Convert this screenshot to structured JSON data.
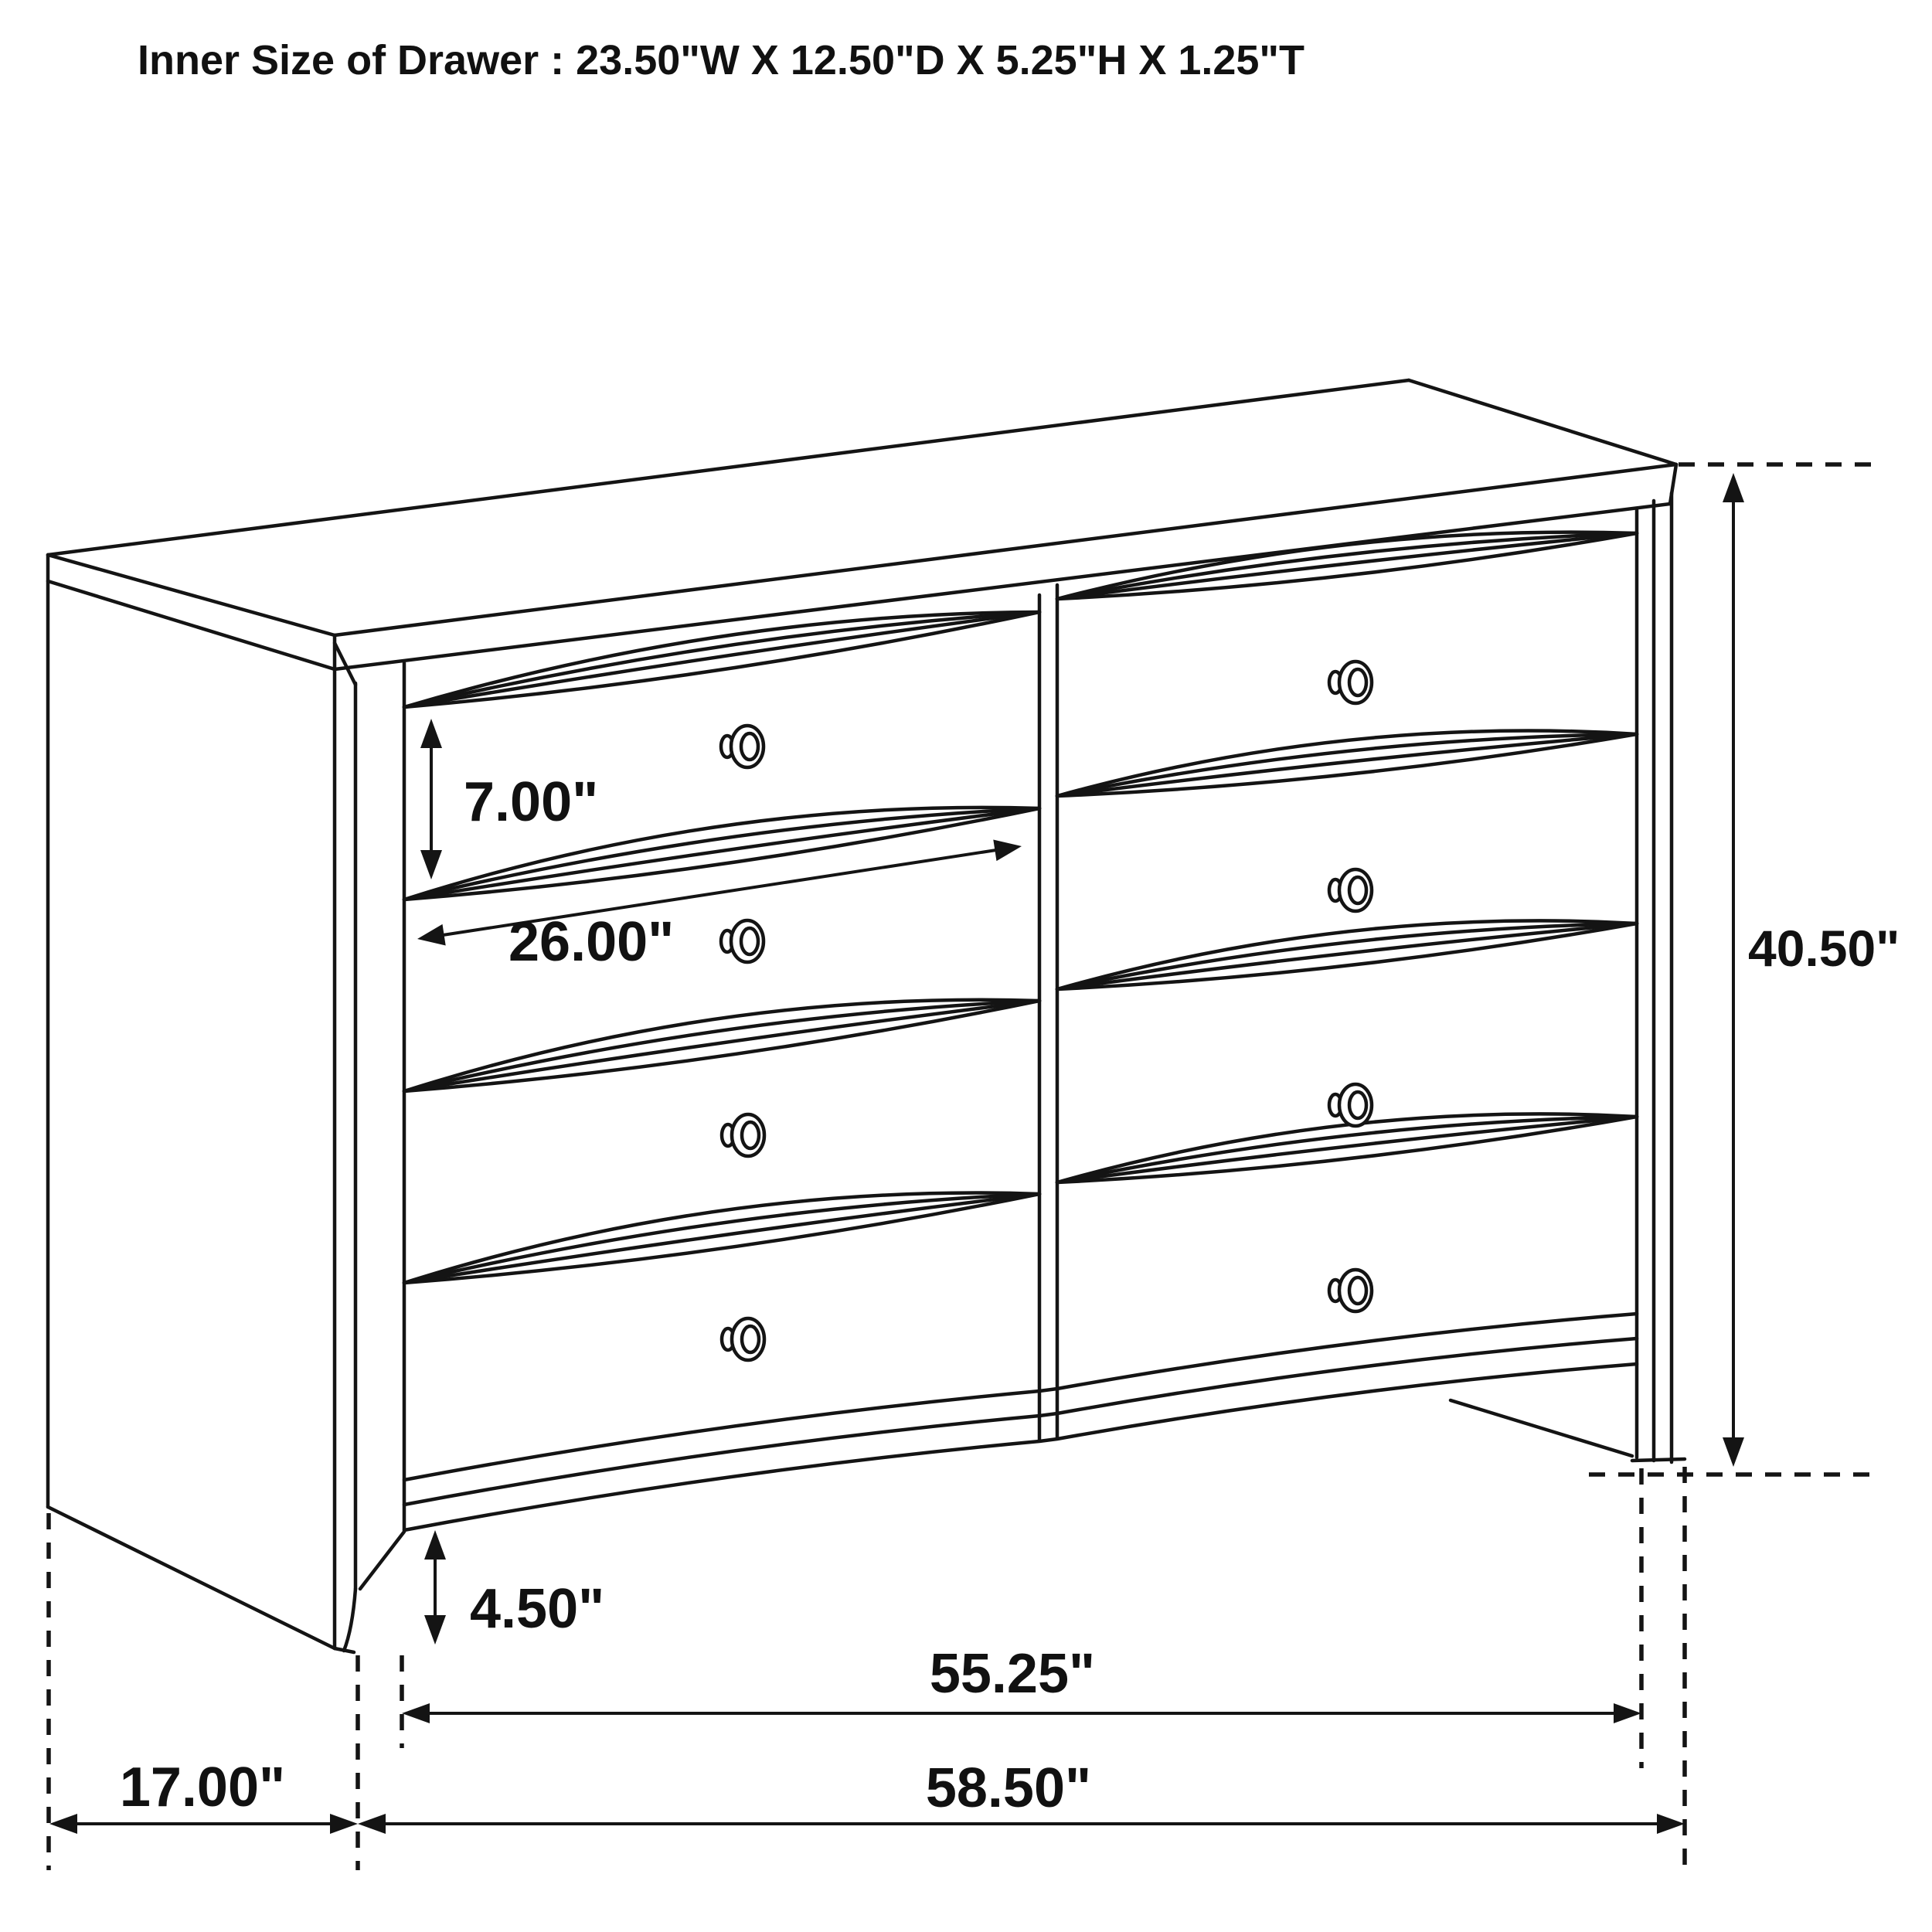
{
  "title": "Inner Size of Drawer : 23.50\"W X 12.50\"D X 5.25\"H X 1.25\"T",
  "drawing": {
    "subject": "8-drawer dresser perspective line drawing",
    "line_color": "#141414",
    "background_color": "#ffffff",
    "units": "inches"
  },
  "dimensions": {
    "drawer_front_height": "7.00\"",
    "drawer_front_width": "26.00\"",
    "overall_height": "40.50\"",
    "base_foot_height": "4.50\"",
    "front_width_between_legs": "55.25\"",
    "side_depth": "17.00\"",
    "overall_width": "58.50\""
  },
  "drawer_inner_size": {
    "width": "23.50\"",
    "depth": "12.50\"",
    "height": "5.25\"",
    "thickness": "1.25\""
  }
}
